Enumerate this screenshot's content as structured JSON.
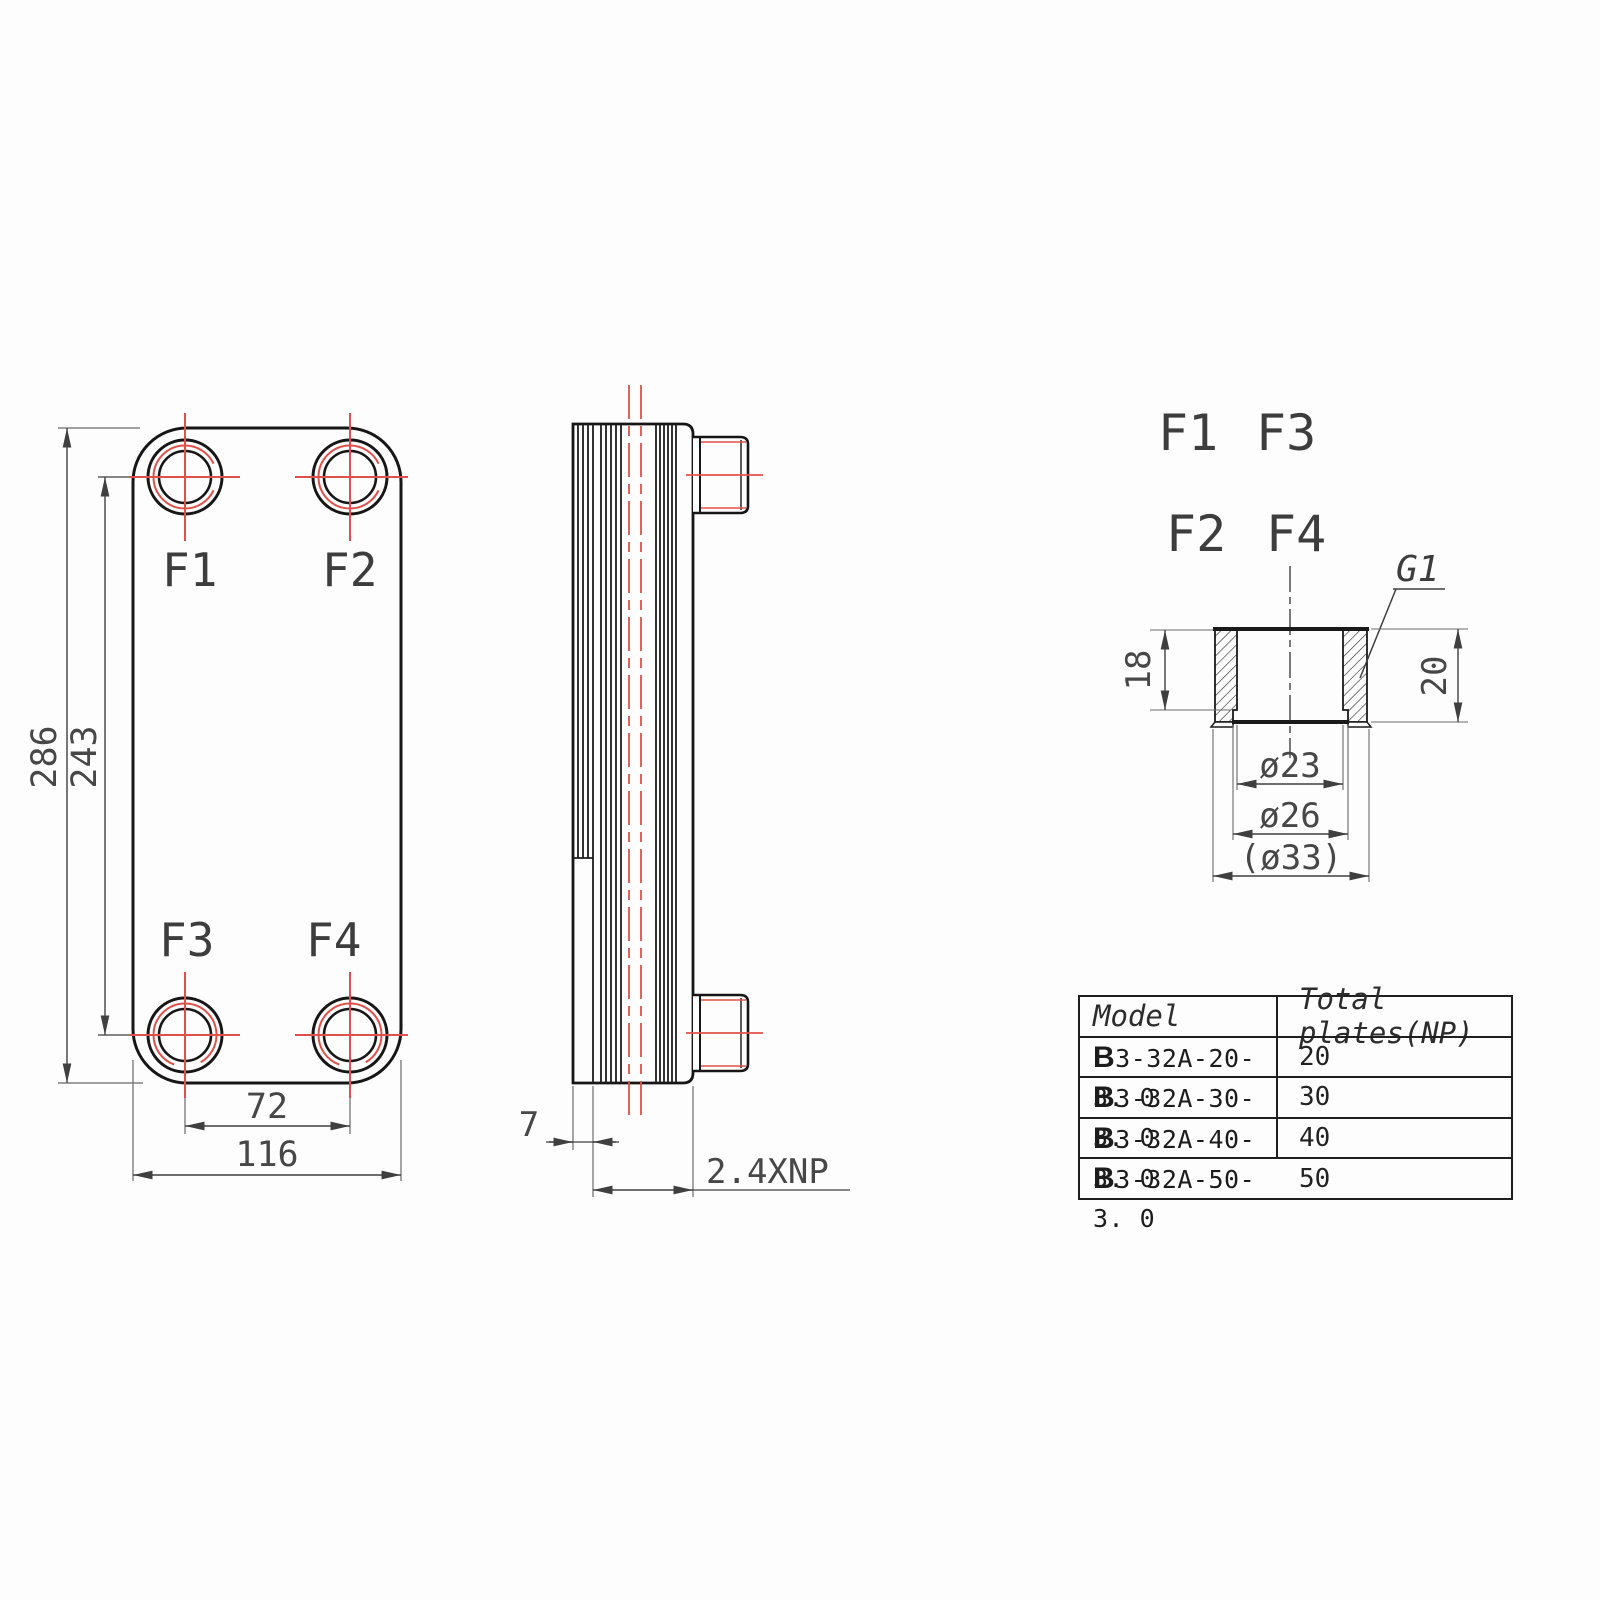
{
  "front_view": {
    "port_labels": {
      "f1": "F1",
      "f2": "F2",
      "f3": "F3",
      "f4": "F4"
    },
    "dimensions": {
      "overall_height": "286",
      "port_center_height": "243",
      "port_center_width": "72",
      "overall_width": "116"
    }
  },
  "side_view": {
    "dimensions": {
      "end_plate_thickness": "7",
      "stack_length": "2.4XNP"
    }
  },
  "port_layout": {
    "labels": [
      "F1",
      "F3",
      "F2",
      "F4"
    ]
  },
  "fitting_detail": {
    "connection_label": "G1",
    "dimensions": {
      "thread_length": "18",
      "total_height": "20",
      "bore_diameter": "ø23",
      "mid_diameter": "ø26",
      "outer_diameter": "(ø33)"
    }
  },
  "spec_table": {
    "headers": {
      "model": "Model",
      "plates": "Total plates(NP)"
    },
    "rows": [
      {
        "model": "B3-32A-20-3. 0",
        "plates": "20"
      },
      {
        "model": "B3-32A-30-3. 0",
        "plates": "30"
      },
      {
        "model": "B3-32A-40-3. 0",
        "plates": "40"
      },
      {
        "model": "B3-32A-50-3. 0",
        "plates": "50"
      }
    ]
  },
  "colors": {
    "outline": "#161616",
    "dimension": "#3f3f3f",
    "accent_red": "#e0504a",
    "background": "#fdfdfd"
  }
}
